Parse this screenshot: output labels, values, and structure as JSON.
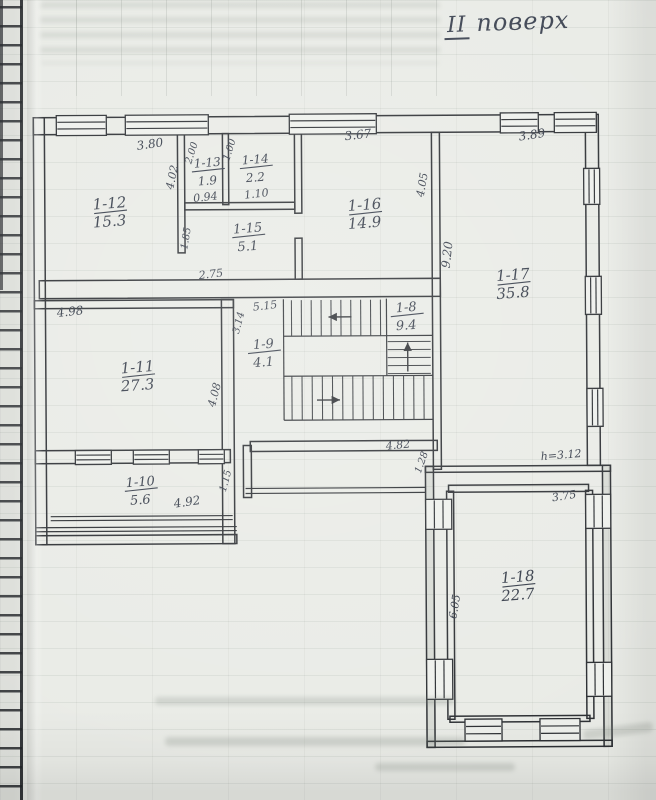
{
  "header": {
    "floor_roman": "II",
    "floor_word": "поверх"
  },
  "colors": {
    "paper": "#e9ebe6",
    "ink": "#343b48",
    "line": "#2b2e32"
  },
  "plan": {
    "walls": [
      [
        35,
        116,
        563,
        17
      ],
      [
        35,
        116,
        11,
        427
      ],
      [
        40,
        279,
        401,
        18
      ],
      [
        587,
        116,
        13,
        351
      ],
      [
        433,
        133,
        8,
        337
      ],
      [
        179,
        133,
        7,
        119
      ],
      [
        224,
        133,
        6,
        71
      ],
      [
        296,
        133,
        7,
        80
      ],
      [
        296,
        238,
        7,
        41
      ],
      [
        186,
        202,
        110,
        7
      ],
      [
        35,
        299,
        199,
        8
      ],
      [
        222,
        299,
        12,
        244
      ],
      [
        35,
        449,
        195,
        13
      ],
      [
        35,
        534,
        201,
        9
      ],
      [
        250,
        441,
        187,
        10
      ],
      [
        243,
        445,
        8,
        52
      ],
      [
        425,
        467,
        185,
        6
      ],
      [
        448,
        486,
        140,
        7
      ],
      [
        425,
        467,
        8,
        281,
        1
      ],
      [
        446,
        492,
        7,
        228
      ],
      [
        602,
        467,
        8,
        281,
        1
      ],
      [
        585,
        492,
        7,
        228
      ],
      [
        448,
        717,
        140,
        6
      ],
      [
        425,
        742,
        185,
        6
      ]
    ],
    "lines": [
      [
        284,
        299,
        284,
        420
      ],
      [
        284,
        336,
        433,
        336
      ],
      [
        284,
        376,
        433,
        376
      ],
      [
        284,
        420,
        433,
        420
      ],
      [
        387,
        299,
        387,
        376
      ],
      [
        245,
        488,
        425,
        488
      ],
      [
        245,
        493,
        425,
        493
      ],
      [
        50,
        515,
        232,
        515
      ],
      [
        50,
        519,
        232,
        519
      ],
      [
        35,
        526,
        236,
        526
      ],
      [
        35,
        530,
        236,
        530
      ]
    ],
    "windows": [
      [
        58,
        114,
        50,
        20,
        "h"
      ],
      [
        127,
        114,
        83,
        20,
        "h"
      ],
      [
        291,
        114,
        87,
        20,
        "h"
      ],
      [
        502,
        114,
        38,
        20,
        "h"
      ],
      [
        556,
        114,
        42,
        20,
        "h"
      ],
      [
        585,
        170,
        16,
        36,
        "v"
      ],
      [
        586,
        278,
        16,
        38,
        "v"
      ],
      [
        587,
        390,
        16,
        38,
        "v"
      ],
      [
        75,
        449,
        36,
        14,
        "h"
      ],
      [
        133,
        449,
        36,
        14,
        "h"
      ],
      [
        198,
        449,
        26,
        14,
        "h"
      ],
      [
        425,
        500,
        26,
        30,
        "v"
      ],
      [
        425,
        660,
        26,
        40,
        "v"
      ],
      [
        585,
        496,
        25,
        34,
        "v"
      ],
      [
        585,
        664,
        25,
        34,
        "v"
      ],
      [
        463,
        720,
        37,
        22,
        "h"
      ],
      [
        538,
        720,
        40,
        22,
        "h"
      ]
    ],
    "treads_v": [
      {
        "x1": 292,
        "x2": 381,
        "n": 10,
        "y1": 300,
        "y2": 336
      },
      {
        "x1": 292,
        "x2": 424,
        "n": 14,
        "y1": 376,
        "y2": 420
      }
    ],
    "treads_h": [
      {
        "y1": 342,
        "y2": 374,
        "n": 5,
        "x1": 388,
        "x2": 431
      }
    ],
    "arrows": [
      [
        352,
        317,
        329,
        317
      ],
      [
        408,
        372,
        408,
        343
      ],
      [
        317,
        400,
        340,
        400
      ]
    ],
    "rooms": [
      {
        "id": "1-12",
        "area": "15.3",
        "x": 111,
        "y": 207,
        "s": 15
      },
      {
        "id": "1-13",
        "area": "1.9",
        "x": 209,
        "y": 166,
        "s": 12
      },
      {
        "id": "1-14",
        "area": "2.2",
        "x": 257,
        "y": 163,
        "s": 12
      },
      {
        "id": "1-15",
        "area": "5.1",
        "x": 249,
        "y": 232,
        "s": 13
      },
      {
        "id": "1-16",
        "area": "14.9",
        "x": 366,
        "y": 210,
        "s": 15
      },
      {
        "id": "1-17",
        "area": "35.8",
        "x": 514,
        "y": 281,
        "s": 15
      },
      {
        "id": "1-9",
        "area": "4.1",
        "x": 264,
        "y": 348,
        "s": 13
      },
      {
        "id": "1-8",
        "area": "9.4",
        "x": 407,
        "y": 312,
        "s": 13
      },
      {
        "id": "1-11",
        "area": "27.3",
        "x": 138,
        "y": 371,
        "s": 15
      },
      {
        "id": "1-10",
        "area": "5.6",
        "x": 140,
        "y": 485,
        "s": 13
      },
      {
        "id": "1-18",
        "area": "22.7",
        "x": 517,
        "y": 583,
        "s": 15
      }
    ],
    "dims": [
      {
        "t": "3.80",
        "x": 152,
        "y": 147,
        "r": -8,
        "s": 12
      },
      {
        "t": "2.00",
        "x": 196,
        "y": 153,
        "r": -72,
        "s": 10
      },
      {
        "t": "1.00",
        "x": 234,
        "y": 150,
        "r": -72,
        "s": 10
      },
      {
        "t": "4.02",
        "x": 177,
        "y": 177,
        "r": -78,
        "s": 11
      },
      {
        "t": "0.94",
        "x": 207,
        "y": 200,
        "r": -6,
        "s": 11
      },
      {
        "t": "1.10",
        "x": 258,
        "y": 197,
        "r": -6,
        "s": 11
      },
      {
        "t": "1.85",
        "x": 190,
        "y": 238,
        "r": -80,
        "s": 10
      },
      {
        "t": "2.75",
        "x": 212,
        "y": 277,
        "r": -6,
        "s": 11
      },
      {
        "t": "3.67",
        "x": 360,
        "y": 139,
        "r": -6,
        "s": 12
      },
      {
        "t": "4.05",
        "x": 427,
        "y": 186,
        "r": -80,
        "s": 11
      },
      {
        "t": "3.89",
        "x": 534,
        "y": 140,
        "r": -8,
        "s": 12
      },
      {
        "t": "9.20",
        "x": 452,
        "y": 256,
        "r": -83,
        "s": 12
      },
      {
        "t": "4.98",
        "x": 71,
        "y": 314,
        "r": -6,
        "s": 12
      },
      {
        "t": "5.15",
        "x": 266,
        "y": 309,
        "r": -6,
        "s": 11
      },
      {
        "t": "3.14",
        "x": 242,
        "y": 323,
        "r": -75,
        "s": 10
      },
      {
        "t": "4.08",
        "x": 218,
        "y": 395,
        "r": -75,
        "s": 11
      },
      {
        "t": "1.15",
        "x": 228,
        "y": 481,
        "r": -75,
        "s": 10
      },
      {
        "t": "4.92",
        "x": 187,
        "y": 505,
        "r": -8,
        "s": 12
      },
      {
        "t": "4.82",
        "x": 398,
        "y": 449,
        "r": -5,
        "s": 11
      },
      {
        "t": "1.28",
        "x": 424,
        "y": 464,
        "r": -70,
        "s": 10
      },
      {
        "t": "h=3.12",
        "x": 561,
        "y": 460,
        "r": -4,
        "s": 11
      },
      {
        "t": "3.75",
        "x": 564,
        "y": 501,
        "r": -8,
        "s": 11
      },
      {
        "t": "6.05",
        "x": 457,
        "y": 608,
        "r": -80,
        "s": 11
      }
    ]
  }
}
